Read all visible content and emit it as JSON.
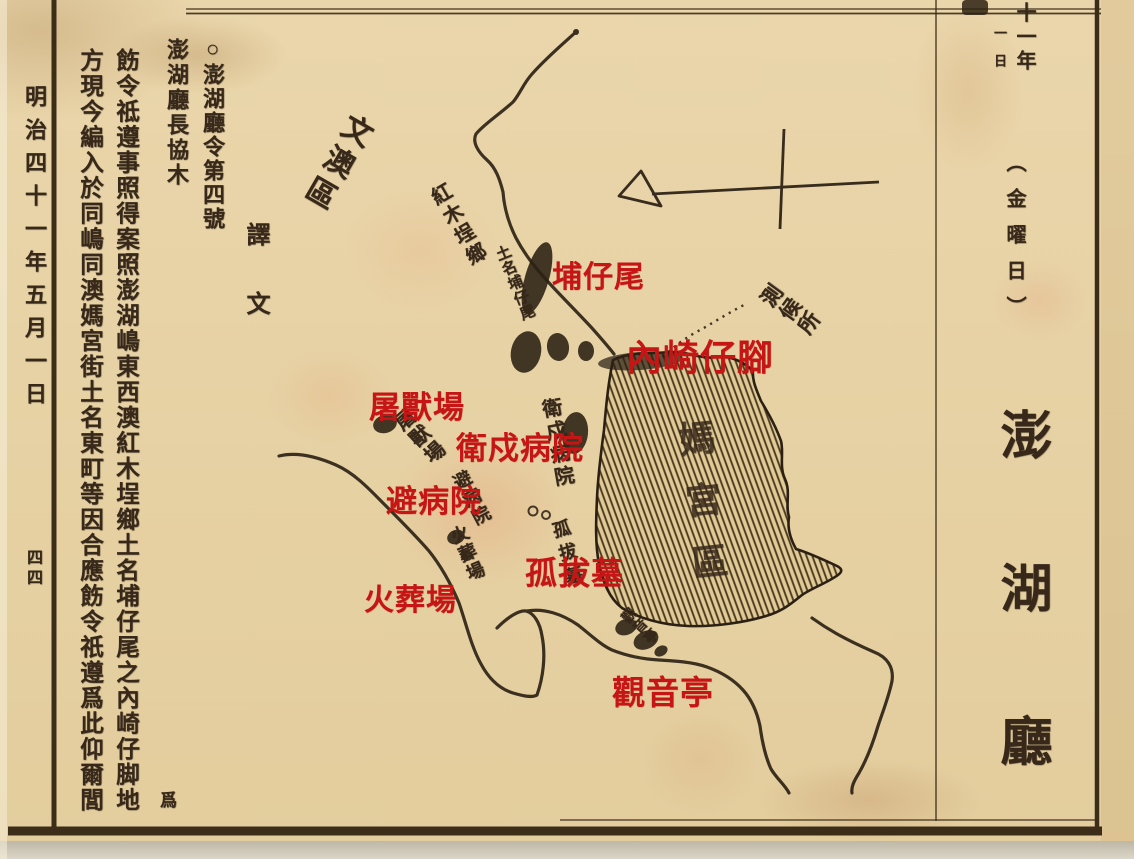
{
  "page": {
    "left_margin": {
      "date": "明治四十一年五月一日",
      "page_number": "四四"
    },
    "decree": {
      "title": "○澎湖廳令第四號",
      "signature": "澎湖廳長協木",
      "translation_label": "譯文",
      "stray_char": "爲",
      "column_1": "飭令祗遵事照得案照澎湖嶋東西澳紅木埕鄉土名埔仔尾之內崎仔脚地",
      "column_2": "方現今編入於同嶋同澳媽宮街土名東町等因合應飭令祇遵爲此仰爾閭"
    },
    "right_margin": {
      "year": "十一年",
      "day": "一日",
      "weekday": "（金曜日）",
      "section_title": "澎湖廳"
    },
    "map": {
      "district_labels": {
        "wenao": "文澳區",
        "magong": "媽宮區"
      },
      "ink_labels": {
        "hongmutan_village": "紅木埕鄉",
        "puzaiwei_small": "土名埔仔尾",
        "garrison_hospital": "衛戍病院",
        "slaughterhouse": "屠獸場",
        "isolation_hospital": "避病院",
        "crematory": "火葬場",
        "courbet_tomb": "孤拔墓",
        "guanyin_pavilion": "觀音亭",
        "observatory": "測候所"
      },
      "red_annotations": [
        {
          "text": "埔仔尾"
        },
        {
          "text": "內崎仔腳"
        },
        {
          "text": "屠獸場"
        },
        {
          "text": "衛戍病院"
        },
        {
          "text": "避病院"
        },
        {
          "text": "孤拔墓"
        },
        {
          "text": "火葬場"
        },
        {
          "text": "觀音亭"
        }
      ],
      "colors": {
        "annotation_red": "#c51515",
        "ink": "#37281a",
        "paper": "#e7d2a6"
      }
    }
  }
}
